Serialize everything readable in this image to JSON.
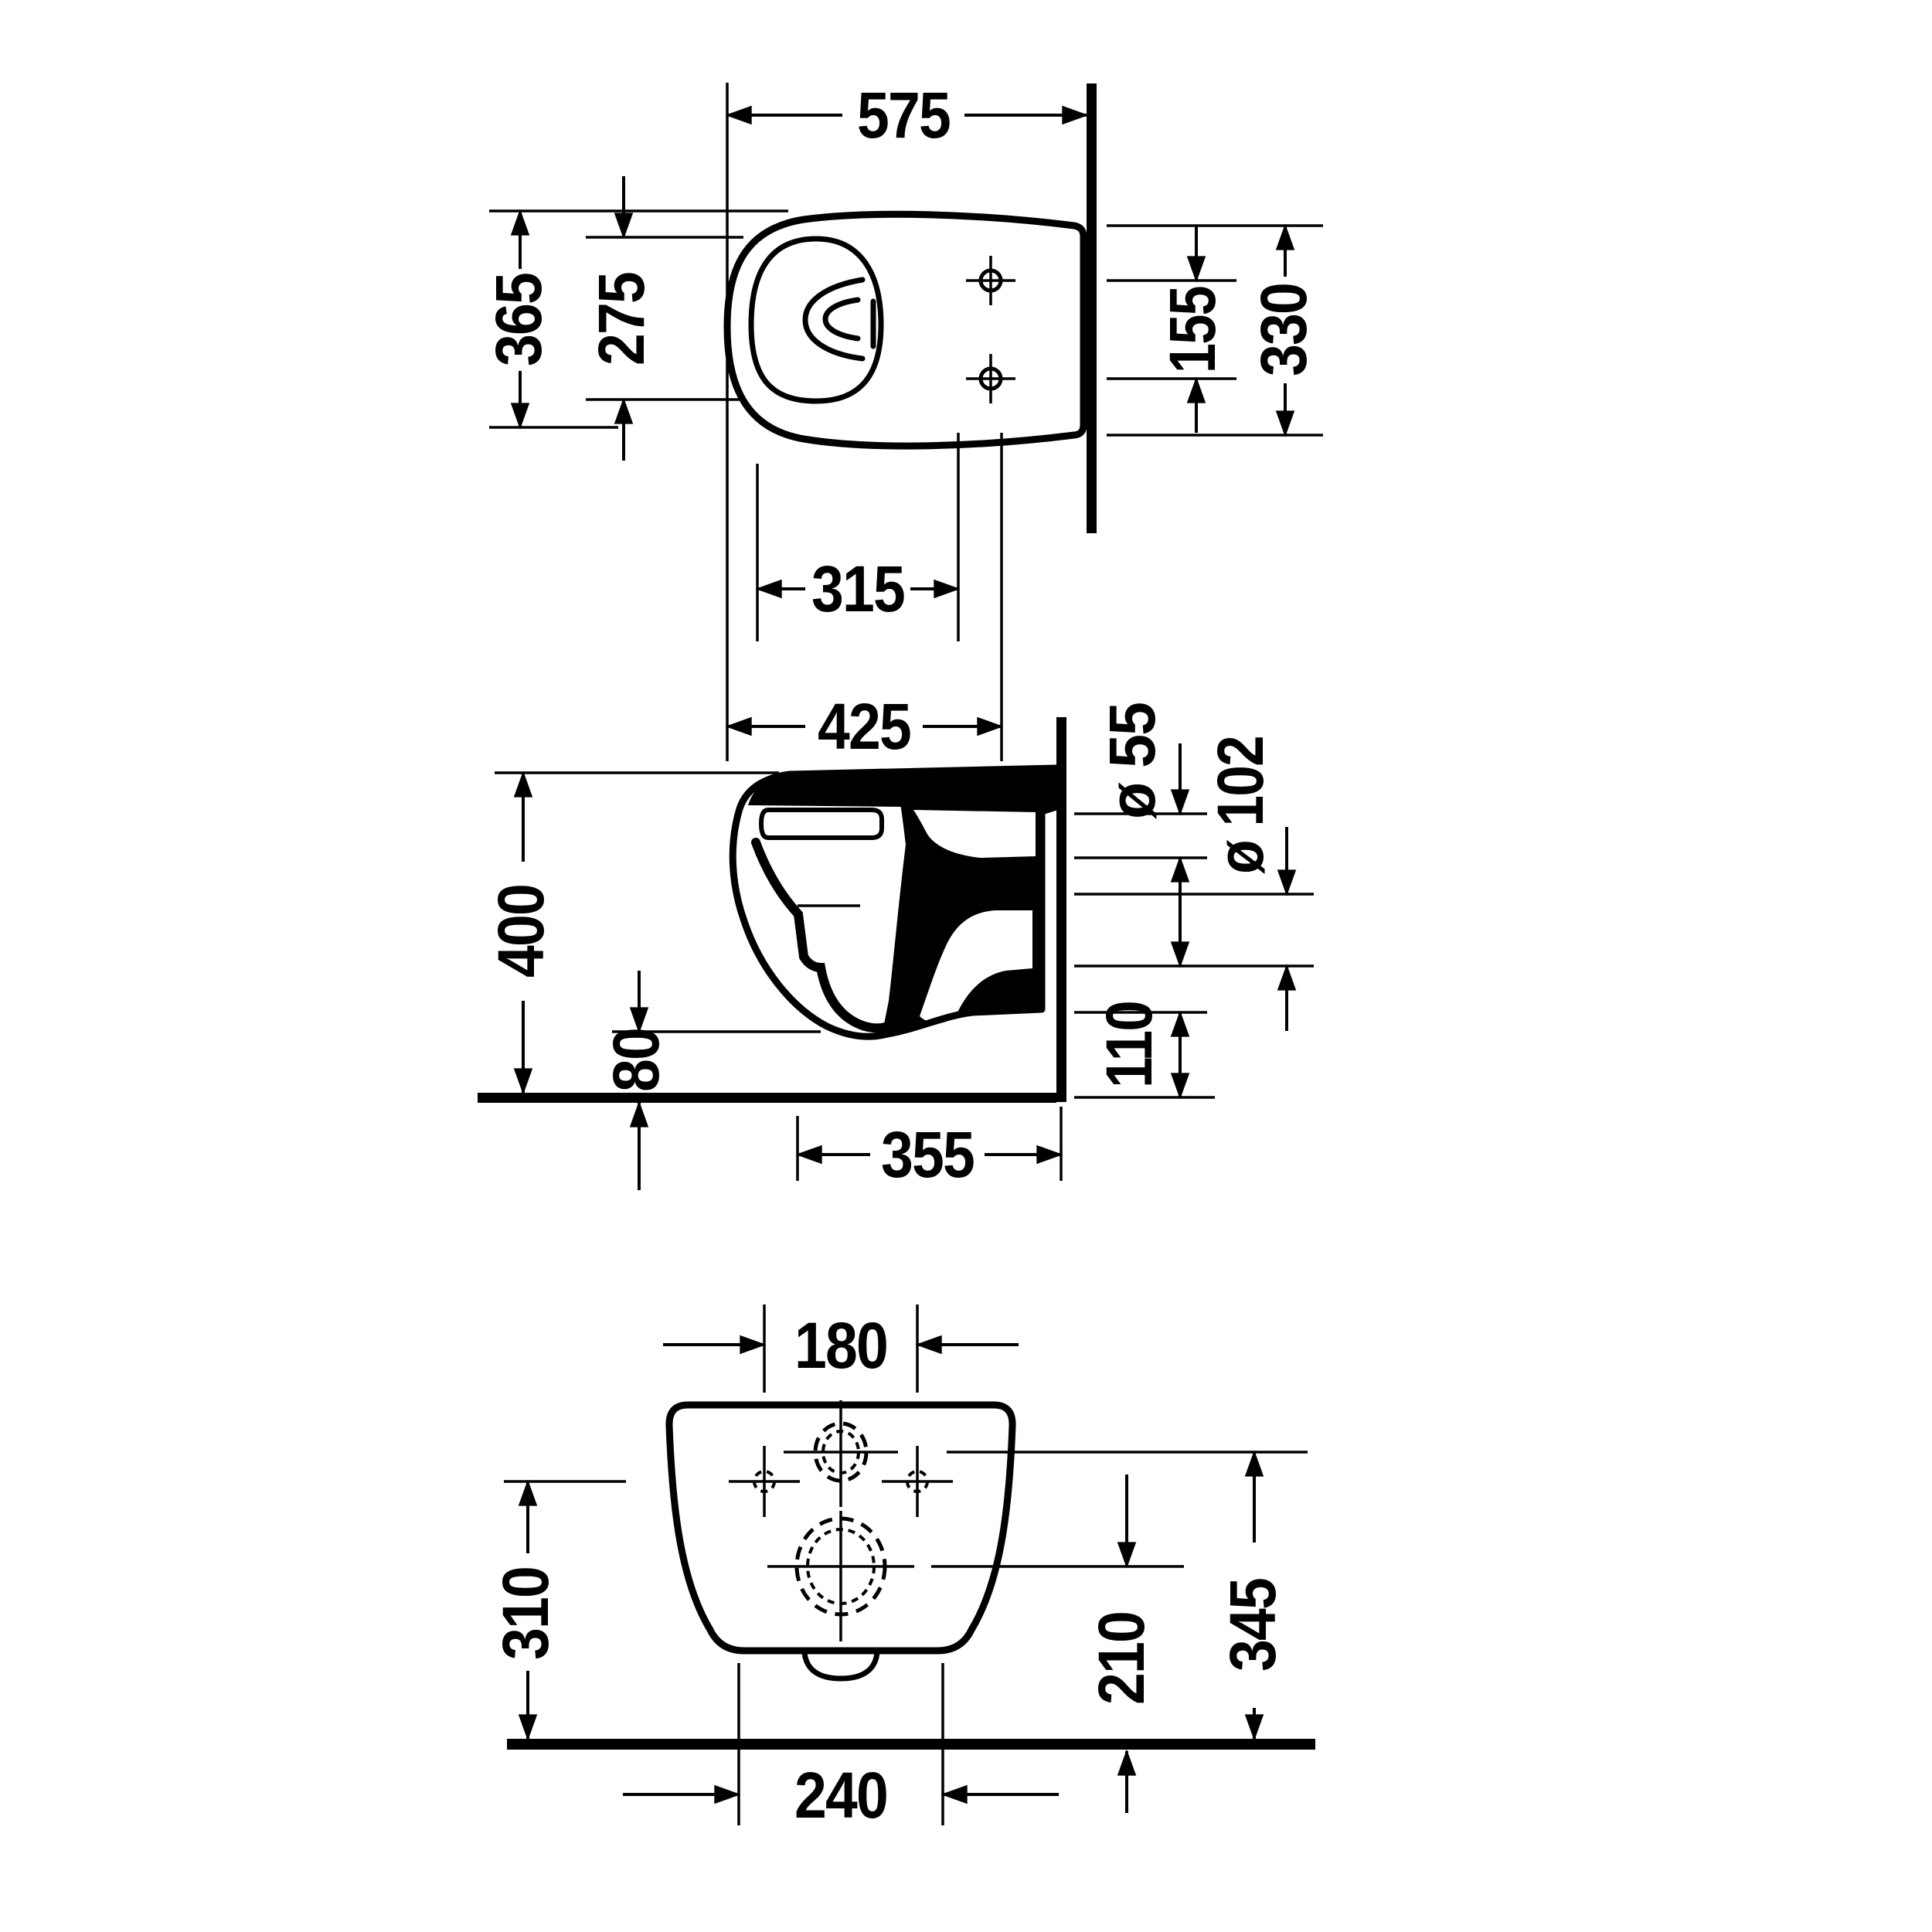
{
  "drawing": {
    "kind": "sanitary-ware dimensional drawing, wall-hung toilet, three orthographic views",
    "background_color": "#ffffff",
    "line_color": "#000000",
    "views": {
      "top": {
        "label": "top-view",
        "dims": {
          "depth_wall_to_front": "575",
          "overall_width": "365",
          "inner_bowl_width": "275",
          "opening_to_holes": "315",
          "front_to_holes": "425",
          "fixing_holes_spacing": "155",
          "back_width_at_wall": "330"
        }
      },
      "side": {
        "label": "side-section-view",
        "dims": {
          "overall_height": "400",
          "bowl_underside_height": "80",
          "flush_inlet_diameter": "ø 55",
          "outlet_diameter": "ø 102",
          "underside_depth_from_wall": "355",
          "ceramic_bottom_edge_height": "110"
        }
      },
      "rear": {
        "label": "rear-view",
        "dims": {
          "fixing_holes_spacing": "180",
          "fixing_holes_height": "310",
          "outlet_center_height": "210",
          "inlet_center_height": "345",
          "base_width": "240"
        }
      }
    }
  }
}
